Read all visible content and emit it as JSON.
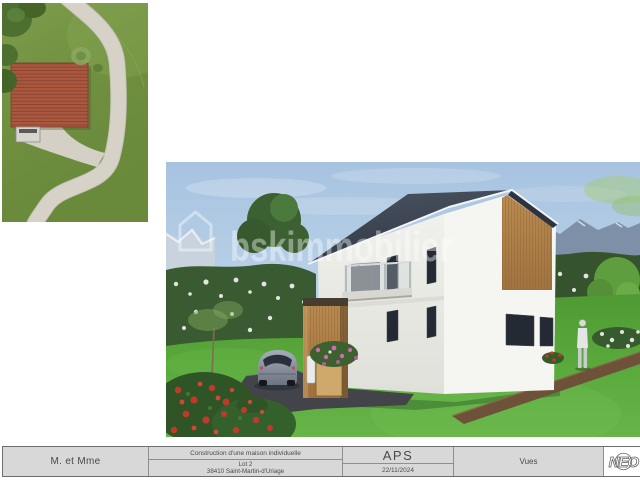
{
  "titleblock": {
    "client": "M. et Mme",
    "project": "Construction d'une maison individuelle",
    "lot": "Lot 2",
    "address": "38410 Saint-Martin-d'Uriage",
    "phase": "APS",
    "date": "22/11/2024",
    "sheet": "Vues",
    "logo": "NEO"
  },
  "render": {
    "watermark": {
      "text": "bskimmobilier",
      "icon": "house-outline-icon"
    },
    "colors": {
      "sky": "#a7c3e0",
      "roof": "#3a4450",
      "wall": "#f2f2ee",
      "wood": "#b5854e",
      "lawn": "#5aa93c",
      "mountains": "#7e90a7",
      "asphalt": "#43444a",
      "path": "#6d5138"
    }
  },
  "site_plan": {
    "colors": {
      "grass": "#6f903f",
      "road": "#d6d2c8",
      "roof_tiles": "#a9573f",
      "trees": "#4d7031"
    }
  }
}
